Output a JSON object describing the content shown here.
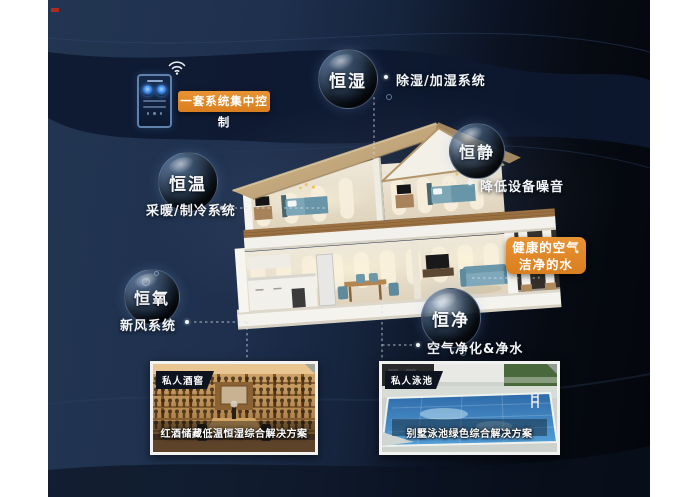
{
  "poster": {
    "systems": [
      {
        "bubble": "恒湿",
        "label": "除湿/加湿系统"
      },
      {
        "bubble": "恒静",
        "label": "降低设备噪音"
      },
      {
        "bubble": "恒温",
        "label": "采暖/制冷系统"
      },
      {
        "bubble": "恒氧",
        "label": "新风系统"
      },
      {
        "bubble": "恒净",
        "label": "空气净化&净水"
      }
    ],
    "callouts": {
      "central_control": "一套系统集中控制",
      "healthy_air": "健康的空气",
      "clean_water": "洁净的水"
    },
    "photos": [
      {
        "badge": "私人酒窖",
        "caption": "红酒储藏低温恒湿综合解决方案"
      },
      {
        "badge": "私人泳池",
        "caption": "别墅泳池绿色综合解决方案"
      }
    ],
    "icons": {
      "wifi": "wifi-icon",
      "phone": "smart-home-controller"
    },
    "colors": {
      "accent_orange": "#e0892a",
      "background_navy": "#1d2f4d",
      "background_dark": "#070b13",
      "pool_blue": "#3f82bf",
      "wood": "#b98c54"
    }
  }
}
